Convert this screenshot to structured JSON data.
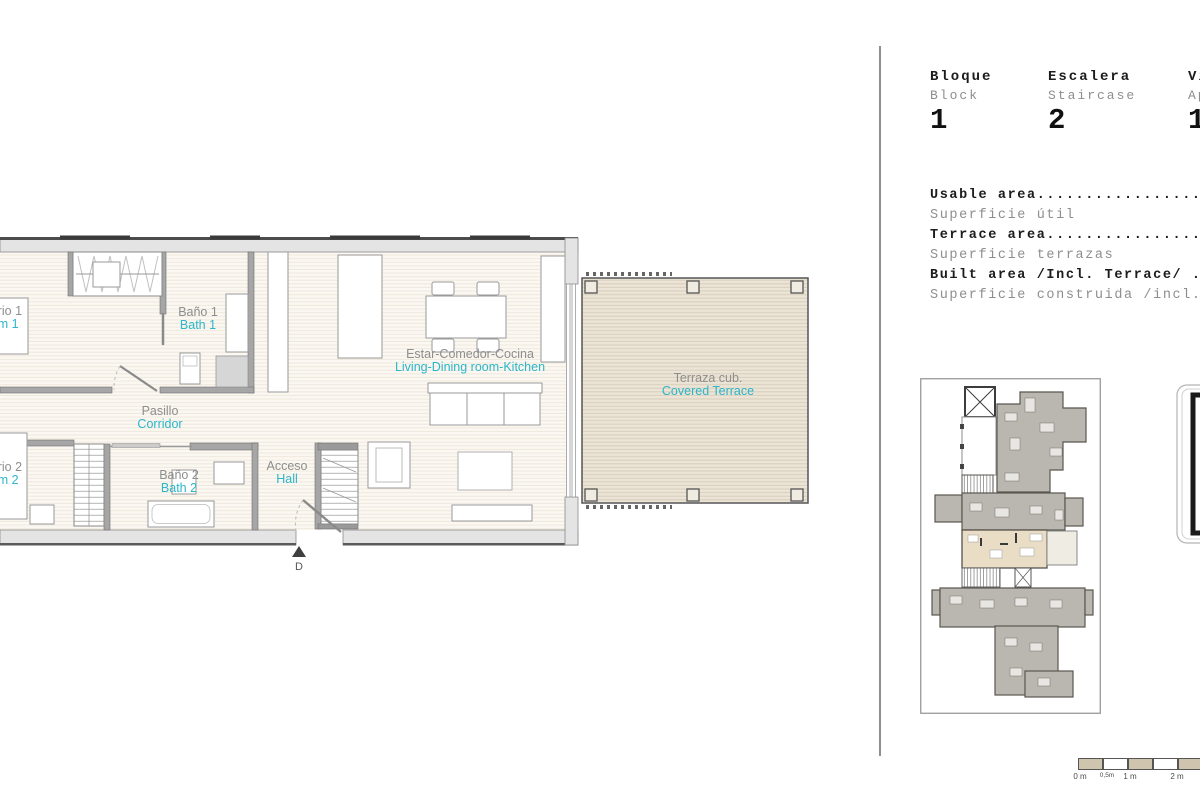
{
  "header": {
    "columns": [
      {
        "label_es": "Bloque",
        "label_en": "Block",
        "value": "1"
      },
      {
        "label_es": "Escalera",
        "label_en": "Staircase",
        "value": "2"
      },
      {
        "label_es": "Vivienda",
        "label_en": "Apartment",
        "value": "1"
      }
    ]
  },
  "areas": {
    "rows": [
      {
        "title": "Usable area...............................................",
        "subtitle": "Superficie útil"
      },
      {
        "title": "Terrace area..............................................",
        "subtitle": "Superficie terrazas"
      },
      {
        "title": "Built area /Incl. Terrace/ ...............................",
        "subtitle": "Superficie construida /incl. terrazas/"
      }
    ]
  },
  "plan": {
    "rooms": {
      "bedroom1": {
        "es": "Dormitorio 1",
        "en": "Bedroom 1"
      },
      "bath1": {
        "es": "Baño 1",
        "en": "Bath 1"
      },
      "corridor": {
        "es": "Pasillo",
        "en": "Corridor"
      },
      "bedroom2": {
        "es": "Dormitorio 2",
        "en": "Bedroom 2"
      },
      "bath2": {
        "es": "Baño 2",
        "en": "Bath 2"
      },
      "hall": {
        "es": "Acceso",
        "en": "Hall"
      },
      "living": {
        "es": "Estar-Comedor-Cocina",
        "en": "Living-Dining room-Kitchen"
      },
      "terrace": {
        "es": "Terraza cub.",
        "en": "Covered Terrace"
      }
    },
    "entrance_marker": "D"
  },
  "scalebar": {
    "labels": [
      "0 m",
      "0,5m",
      "1 m",
      "2 m"
    ]
  },
  "colors": {
    "accent": "#2bb6c9",
    "label_gray": "#8e8e8e",
    "terrace_fill": "#eae3d5",
    "wall_light": "#e4e4e4",
    "wall_mid": "#a6a6a6",
    "unit_gray": "#bab6b0",
    "unit_highlight": "#e9ddc6",
    "scalebar_tan": "#cfc4ae"
  }
}
